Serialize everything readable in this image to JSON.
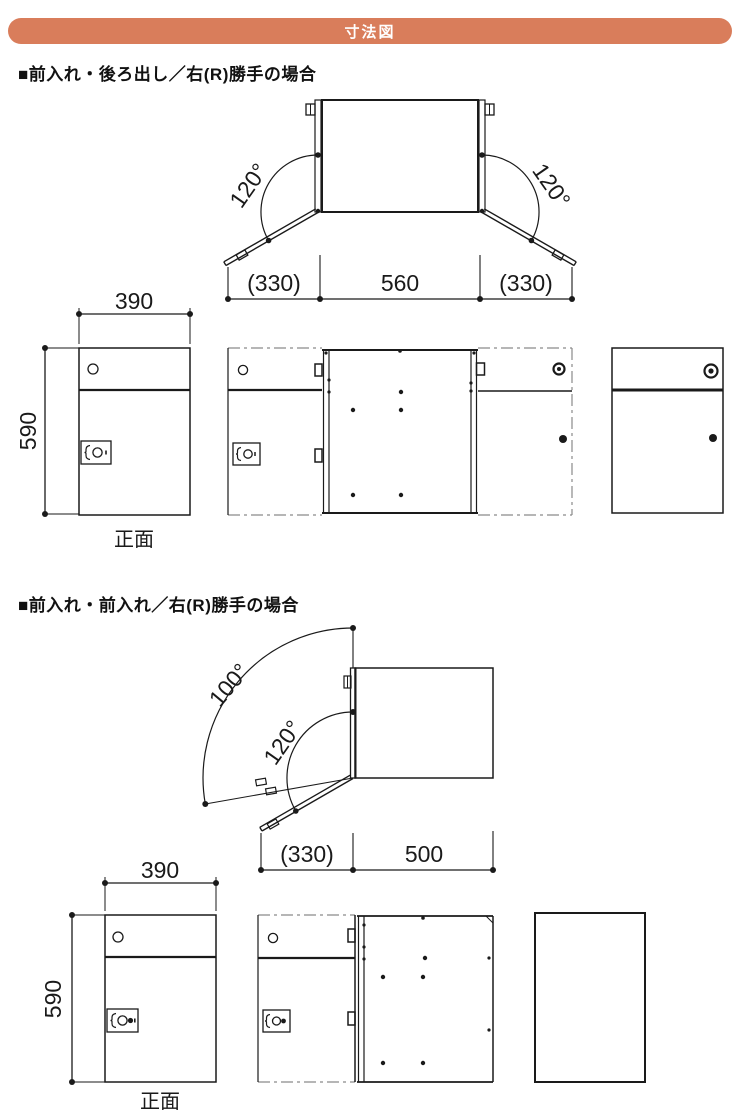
{
  "header": {
    "title": "寸法図",
    "bg_color": "#d97d5b",
    "text_color": "#ffffff"
  },
  "sections": [
    {
      "title": "■前入れ・後ろ出し／右(R)勝手の場合",
      "plan": {
        "angle_left": "120°",
        "angle_right": "120°",
        "dim_left": "(330)",
        "dim_center": "560",
        "dim_right": "(330)"
      },
      "front": {
        "dim_width": "390",
        "dim_height": "590",
        "label": "正面"
      }
    },
    {
      "title": "■前入れ・前入れ／右(R)勝手の場合",
      "plan": {
        "angle_outer": "100°",
        "angle_inner": "120°",
        "dim_left": "(330)",
        "dim_right": "500"
      },
      "front": {
        "dim_width": "390",
        "dim_height": "590",
        "label": "正面"
      }
    }
  ],
  "drawing": {
    "line_color": "#1a1a1a",
    "hidden_line_color": "#8a8a8a"
  }
}
